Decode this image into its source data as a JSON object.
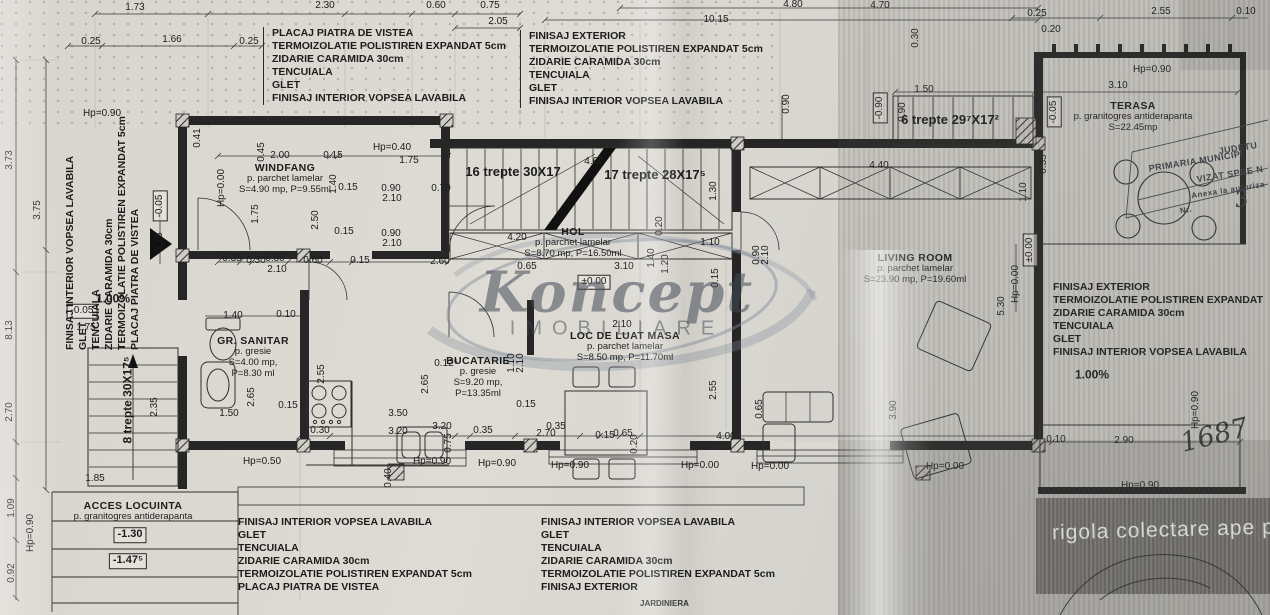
{
  "watermark": {
    "name": "Koncept",
    "subtitle": "IMOBILIARE"
  },
  "notes": {
    "rigola": "rigola colectare ape pluvi",
    "jardiniera": "JARDINIERA",
    "number": "1687"
  },
  "stamp": {
    "lines": [
      {
        "t": "JUDETU",
        "x": 1238,
        "y": 148,
        "fs": 9
      },
      {
        "t": "PRIMARIA MUNICIPI",
        "x": 1196,
        "y": 161,
        "fs": 9
      },
      {
        "t": "VIZAT SPRE N",
        "x": 1230,
        "y": 174,
        "fs": 9
      },
      {
        "t": "Anexa la autoriza",
        "x": 1228,
        "y": 190,
        "fs": 8
      },
      {
        "t": "Nr.",
        "x": 1186,
        "y": 210,
        "fs": 8
      },
      {
        "t": "3",
        "x": 1242,
        "y": 200,
        "fs": 22,
        "hand": 1
      }
    ]
  },
  "spec_blocks": [
    {
      "id": "top-left",
      "x": 263,
      "y": 27,
      "bar": true,
      "vert": false,
      "lines": [
        "PLACAJ PIATRA DE VISTEA",
        "TERMOIZOLATIE POLISTIREN EXPANDAT 5cm",
        "ZIDARIE CARAMIDA 30cm",
        "TENCUIALA",
        "GLET",
        "FINISAJ INTERIOR VOPSEA LAVABILA"
      ]
    },
    {
      "id": "top-center",
      "x": 520,
      "y": 30,
      "bar": true,
      "vert": false,
      "lines": [
        "FINISAJ EXTERIOR",
        "TERMOIZOLATIE POLISTIREN EXPANDAT 5cm",
        "ZIDARIE CARAMIDA 30cm",
        "TENCUIALA",
        "GLET",
        "FINISAJ INTERIOR VOPSEA LAVABILA"
      ]
    },
    {
      "id": "right",
      "x": 1053,
      "y": 281,
      "bar": false,
      "vert": false,
      "lines": [
        "FINISAJ EXTERIOR",
        "TERMOIZOLATIE POLISTIREN EXPANDAT",
        "ZIDARIE CARAMIDA 30cm",
        "TENCUIALA",
        "GLET",
        "FINISAJ INTERIOR VOPSEA LAVABILA"
      ]
    },
    {
      "id": "bottom-left",
      "x": 238,
      "y": 516,
      "bar": false,
      "vert": false,
      "lines": [
        "FINISAJ INTERIOR VOPSEA LAVABILA",
        "GLET",
        "TENCUIALA",
        "ZIDARIE CARAMIDA 30cm",
        "TERMOIZOLATIE POLISTIREN EXPANDAT 5cm",
        "PLACAJ PIATRA DE VISTEA"
      ]
    },
    {
      "id": "bottom-center",
      "x": 541,
      "y": 516,
      "bar": false,
      "vert": false,
      "lines": [
        "FINISAJ INTERIOR VOPSEA LAVABILA",
        "GLET",
        "TENCUIALA",
        "ZIDARIE CARAMIDA 30cm",
        "TERMOIZOLATIE POLISTIREN EXPANDAT 5cm",
        "FINISAJ EXTERIOR"
      ]
    },
    {
      "id": "left-vertical",
      "x": 64,
      "y": 350,
      "bar": false,
      "vert": true,
      "lines": [
        "FINISAJ INTERIOR VOPSEA LAVABILA",
        "GLET",
        "TENCUIALA",
        "ZIDARIE CARAMIDA 30cm",
        "TERMOIZOLATIE POLISTIREN EXPANDAT 5cm",
        "PLACAJ PIATRA DE VISTEA"
      ]
    }
  ],
  "rooms": [
    {
      "id": "windfang",
      "x": 285,
      "y": 162,
      "title": "WINDFANG",
      "subs": [
        "p. parchet lamelar",
        "S=4.90 mp, P=9.55ml"
      ]
    },
    {
      "id": "hol",
      "x": 573,
      "y": 226,
      "title": "HOL",
      "subs": [
        "p. parchet lamelar",
        "S=8.70 mp, P=16.50ml"
      ]
    },
    {
      "id": "gr-sanitar",
      "x": 253,
      "y": 335,
      "title": "GR. SANITAR",
      "subs": [
        "p. gresie",
        "S=4.00 mp,",
        "P=8.30 ml"
      ]
    },
    {
      "id": "bucatarie",
      "x": 478,
      "y": 355,
      "title": "BUCATARIE",
      "subs": [
        "p. gresie",
        "S=9.20 mp,",
        "P=13.35ml"
      ]
    },
    {
      "id": "loc-de-luat-masa",
      "x": 625,
      "y": 330,
      "title": "LOC DE LUAT MASA",
      "subs": [
        "p. parchet lamelar",
        "S=8.50 mp, P=11.70ml"
      ]
    },
    {
      "id": "living-room",
      "x": 915,
      "y": 252,
      "title": "LIVING ROOM",
      "subs": [
        "p. parchet lamelar",
        "S=23.90 mp, P=19.60ml"
      ]
    },
    {
      "id": "terasa",
      "x": 1133,
      "y": 100,
      "title": "TERASA",
      "subs": [
        "p. granitogres antiderapanta",
        "S=22.45mp"
      ]
    },
    {
      "id": "acces-locuinta",
      "x": 133,
      "y": 500,
      "title": "ACCES LOCUINTA",
      "subs": [
        "p. granitogres antiderapanta"
      ]
    }
  ],
  "dim_labels": [
    {
      "t": "1.73",
      "x": 135,
      "y": 8
    },
    {
      "t": "2.30",
      "x": 325,
      "y": 6
    },
    {
      "t": "0.60",
      "x": 436,
      "y": 6
    },
    {
      "t": "0.75",
      "x": 490,
      "y": 6
    },
    {
      "t": "2.05",
      "x": 498,
      "y": 22
    },
    {
      "t": "4.80",
      "x": 793,
      "y": 5
    },
    {
      "t": "10.15",
      "x": 716,
      "y": 20
    },
    {
      "t": "4.70",
      "x": 880,
      "y": 6
    },
    {
      "t": "0.25",
      "x": 1037,
      "y": 14
    },
    {
      "t": "2.55",
      "x": 1161,
      "y": 12
    },
    {
      "t": "0.10",
      "x": 1246,
      "y": 12
    },
    {
      "t": "0.20",
      "x": 1051,
      "y": 30
    },
    {
      "t": "0.25",
      "x": 91,
      "y": 42
    },
    {
      "t": "1.66",
      "x": 172,
      "y": 40
    },
    {
      "t": "0.25",
      "x": 249,
      "y": 42
    },
    {
      "t": "Hp=0.90",
      "x": 102,
      "y": 114
    },
    {
      "t": "3.73",
      "x": 10,
      "y": 160,
      "r": 1
    },
    {
      "t": "8.13",
      "x": 10,
      "y": 330,
      "r": 1
    },
    {
      "t": "2.70",
      "x": 10,
      "y": 412,
      "r": 1
    },
    {
      "t": "1.09",
      "x": 12,
      "y": 508,
      "r": 1
    },
    {
      "t": "0.92",
      "x": 12,
      "y": 573,
      "r": 1
    },
    {
      "t": "3.75",
      "x": 38,
      "y": 210,
      "r": 1
    },
    {
      "t": "-0.05",
      "x": 160,
      "y": 206,
      "r": 1,
      "b": 1
    },
    {
      "t": "3.75",
      "x": 160,
      "y": 242,
      "r": 1
    },
    {
      "t": "1.00%",
      "x": 113,
      "y": 299,
      "bold": 1,
      "fs": 12
    },
    {
      "t": "-0.05",
      "x": 82,
      "y": 311,
      "b": 1
    },
    {
      "t": "1.75",
      "x": 86,
      "y": 328
    },
    {
      "t": "2.35",
      "x": 155,
      "y": 407,
      "r": 1
    },
    {
      "t": "1.85",
      "x": 95,
      "y": 479
    },
    {
      "t": "Hp=0.90",
      "x": 31,
      "y": 533,
      "r": 1
    },
    {
      "t": "8 trepte 30X17⁵",
      "x": 128,
      "y": 400,
      "r": 1,
      "fs": 12,
      "bold": 1,
      "n": "stair-label-8-trepte"
    },
    {
      "t": "0.41",
      "x": 198,
      "y": 138,
      "r": 1
    },
    {
      "t": "Hp=0.40",
      "x": 392,
      "y": 148
    },
    {
      "t": "2.00",
      "x": 280,
      "y": 156
    },
    {
      "t": "0.15",
      "x": 333,
      "y": 156
    },
    {
      "t": "1.75",
      "x": 409,
      "y": 161
    },
    {
      "t": "0.45",
      "x": 262,
      "y": 152,
      "r": 1
    },
    {
      "t": "Hp=0.00",
      "x": 222,
      "y": 188,
      "r": 1
    },
    {
      "t": "1.40",
      "x": 334,
      "y": 184,
      "r": 1
    },
    {
      "t": "0.15",
      "x": 348,
      "y": 188
    },
    {
      "t": "0.90",
      "x": 391,
      "y": 189
    },
    {
      "t": "2.10",
      "x": 392,
      "y": 199
    },
    {
      "t": "0.70",
      "x": 441,
      "y": 189
    },
    {
      "t": "1.75",
      "x": 256,
      "y": 214,
      "r": 1
    },
    {
      "t": "2.50",
      "x": 316,
      "y": 220,
      "r": 1
    },
    {
      "t": "0.15",
      "x": 344,
      "y": 232
    },
    {
      "t": "0.90",
      "x": 391,
      "y": 234
    },
    {
      "t": "2.10",
      "x": 392,
      "y": 244
    },
    {
      "t": "0.35",
      "x": 232,
      "y": 259
    },
    {
      "t": "0.30",
      "x": 256,
      "y": 261
    },
    {
      "t": "0.80",
      "x": 275,
      "y": 259
    },
    {
      "t": "0.60",
      "x": 313,
      "y": 261
    },
    {
      "t": "0.15",
      "x": 360,
      "y": 261
    },
    {
      "t": "2.60",
      "x": 440,
      "y": 262
    },
    {
      "t": "2.10",
      "x": 277,
      "y": 270
    },
    {
      "t": "16 trepte 30X17",
      "x": 513,
      "y": 172,
      "fs": 13,
      "bold": 1,
      "n": "stair-label-16-trepte"
    },
    {
      "t": "17 trepte 28X17⁵",
      "x": 655,
      "y": 175,
      "fs": 13,
      "bold": 1,
      "n": "stair-label-17-trepte"
    },
    {
      "t": "4.60",
      "x": 594,
      "y": 162
    },
    {
      "t": "4.20",
      "x": 517,
      "y": 238
    },
    {
      "t": "0.20",
      "x": 660,
      "y": 226,
      "r": 1
    },
    {
      "t": "1.30",
      "x": 714,
      "y": 191,
      "r": 1
    },
    {
      "t": "1.10",
      "x": 710,
      "y": 243
    },
    {
      "t": "1.40",
      "x": 652,
      "y": 258,
      "r": 1
    },
    {
      "t": "1.20",
      "x": 666,
      "y": 264,
      "r": 1
    },
    {
      "t": "0.15",
      "x": 716,
      "y": 278,
      "r": 1
    },
    {
      "t": "0.65",
      "x": 527,
      "y": 267
    },
    {
      "t": "3.10",
      "x": 624,
      "y": 267
    },
    {
      "t": "±0.00",
      "x": 594,
      "y": 282,
      "b": 1
    },
    {
      "t": "0.90",
      "x": 787,
      "y": 104,
      "r": 1
    },
    {
      "t": "-0.90",
      "x": 880,
      "y": 108,
      "r": 1,
      "b": 1
    },
    {
      "t": "0.90",
      "x": 903,
      "y": 112,
      "r": 1
    },
    {
      "t": "0.30",
      "x": 916,
      "y": 38,
      "r": 1
    },
    {
      "t": "1.50",
      "x": 924,
      "y": 90
    },
    {
      "t": "6 trepte 29⁷X17²",
      "x": 950,
      "y": 120,
      "fs": 13,
      "bold": 1,
      "n": "stair-label-6-trepte"
    },
    {
      "t": "-0.05",
      "x": 1054,
      "y": 112,
      "r": 1,
      "b": 1
    },
    {
      "t": "0.35",
      "x": 1044,
      "y": 164,
      "r": 1
    },
    {
      "t": "Hp=0.90",
      "x": 1152,
      "y": 70
    },
    {
      "t": "3.10",
      "x": 1118,
      "y": 86
    },
    {
      "t": "4.40",
      "x": 879,
      "y": 166
    },
    {
      "t": "1.10",
      "x": 1024,
      "y": 192,
      "r": 1
    },
    {
      "t": "1.40",
      "x": 233,
      "y": 316
    },
    {
      "t": "0.10",
      "x": 286,
      "y": 315
    },
    {
      "t": "2.55",
      "x": 322,
      "y": 374,
      "r": 1
    },
    {
      "t": "2.65",
      "x": 252,
      "y": 397,
      "r": 1
    },
    {
      "t": "0.15",
      "x": 288,
      "y": 406
    },
    {
      "t": "1.50",
      "x": 229,
      "y": 414
    },
    {
      "t": "0.12⁵",
      "x": 446,
      "y": 364
    },
    {
      "t": "2.65",
      "x": 426,
      "y": 384,
      "r": 1
    },
    {
      "t": "1.10",
      "x": 512,
      "y": 363,
      "r": 1
    },
    {
      "t": "2.10",
      "x": 521,
      "y": 363,
      "r": 1
    },
    {
      "t": "0.15",
      "x": 526,
      "y": 405
    },
    {
      "t": "3.50",
      "x": 398,
      "y": 414
    },
    {
      "t": "3.20",
      "x": 442,
      "y": 427
    },
    {
      "t": "0.35",
      "x": 556,
      "y": 427
    },
    {
      "t": "2.10",
      "x": 622,
      "y": 325
    },
    {
      "t": "2.55",
      "x": 714,
      "y": 390,
      "r": 1
    },
    {
      "t": "0.90",
      "x": 757,
      "y": 255,
      "r": 1
    },
    {
      "t": "2.10",
      "x": 766,
      "y": 255,
      "r": 1
    },
    {
      "t": "5.30",
      "x": 1002,
      "y": 306,
      "r": 1
    },
    {
      "t": "Hp=0.00",
      "x": 1016,
      "y": 284,
      "r": 1
    },
    {
      "t": "±0.00",
      "x": 1030,
      "y": 250,
      "r": 1,
      "b": 1
    },
    {
      "t": "0.65",
      "x": 760,
      "y": 409,
      "r": 1
    },
    {
      "t": "3.90",
      "x": 894,
      "y": 410,
      "r": 1
    },
    {
      "t": "0.30",
      "x": 320,
      "y": 431
    },
    {
      "t": "3.20",
      "x": 398,
      "y": 432
    },
    {
      "t": "0.75",
      "x": 449,
      "y": 443,
      "r": 1
    },
    {
      "t": "0.35",
      "x": 483,
      "y": 431
    },
    {
      "t": "2.70",
      "x": 546,
      "y": 434
    },
    {
      "t": "0.15",
      "x": 605,
      "y": 436
    },
    {
      "t": "0.65",
      "x": 623,
      "y": 434
    },
    {
      "t": "0.20",
      "x": 635,
      "y": 444,
      "r": 1
    },
    {
      "t": "4.00",
      "x": 726,
      "y": 437
    },
    {
      "t": "0.40",
      "x": 389,
      "y": 478,
      "r": 1
    },
    {
      "t": "Hp=0.50",
      "x": 262,
      "y": 462
    },
    {
      "t": "Hp=0.90",
      "x": 432,
      "y": 462
    },
    {
      "t": "Hp=0.90",
      "x": 497,
      "y": 464
    },
    {
      "t": "Hp=0.90",
      "x": 570,
      "y": 466
    },
    {
      "t": "Hp=0.00",
      "x": 700,
      "y": 466
    },
    {
      "t": "Hp=0.00",
      "x": 770,
      "y": 467
    },
    {
      "t": "Hp=0.00",
      "x": 945,
      "y": 467
    },
    {
      "t": "0.10",
      "x": 1056,
      "y": 440
    },
    {
      "t": "2.90",
      "x": 1124,
      "y": 441
    },
    {
      "t": "Hp=0.90",
      "x": 1140,
      "y": 486
    },
    {
      "t": "Hp=0.90",
      "x": 1196,
      "y": 410,
      "r": 1
    },
    {
      "t": "1.00%",
      "x": 1092,
      "y": 375,
      "bold": 1,
      "fs": 12
    },
    {
      "t": "-1.30",
      "x": 130,
      "y": 535,
      "b": 1,
      "fs": 11,
      "bold": 1
    },
    {
      "t": "-1.47⁵",
      "x": 128,
      "y": 561,
      "b": 1,
      "fs": 11,
      "bold": 1
    }
  ]
}
